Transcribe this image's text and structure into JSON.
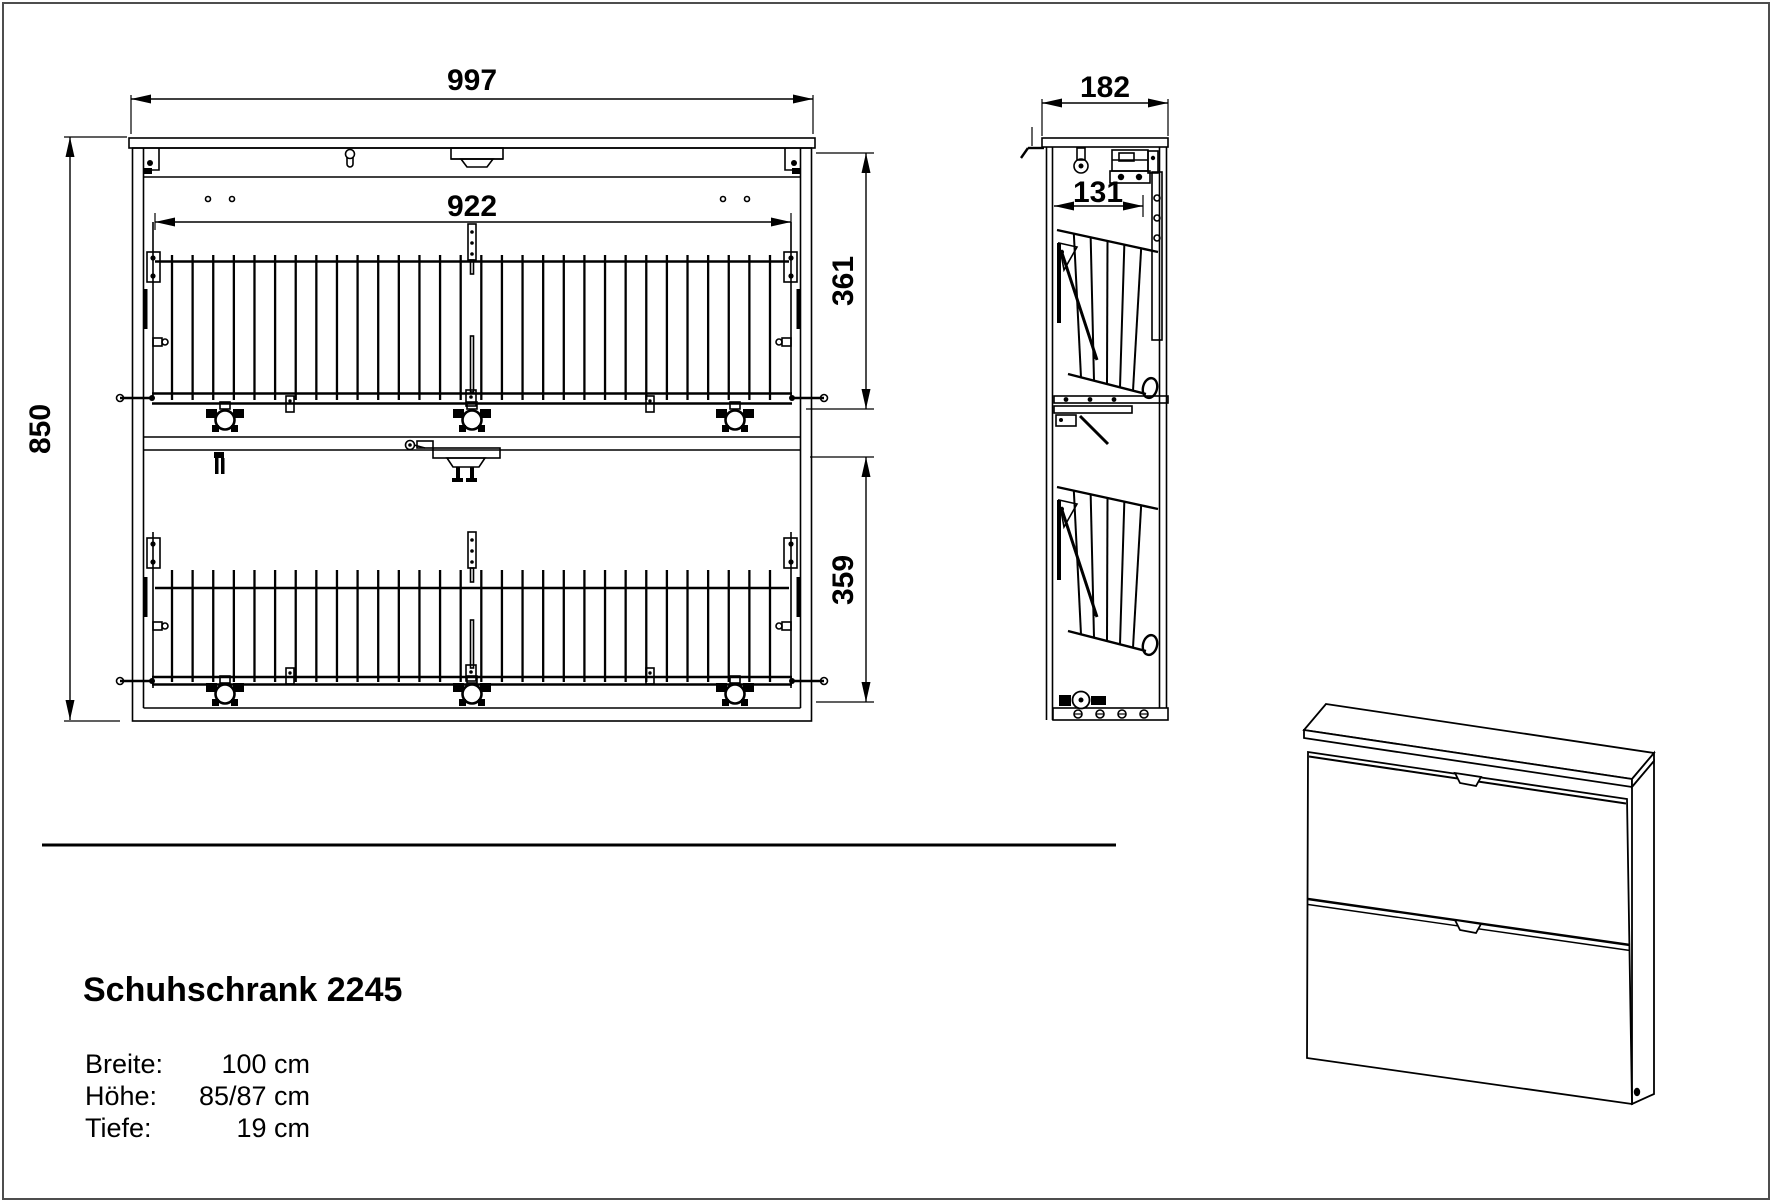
{
  "drawing": {
    "front_view": {
      "width": "997",
      "inner_width": "922",
      "height": "850",
      "upper_compartment": "361",
      "lower_compartment": "359"
    },
    "side_view": {
      "depth": "182",
      "inner_depth": "131"
    }
  },
  "info": {
    "title": "Schuhschrank 2245",
    "specs": [
      {
        "label": "Breite:",
        "value": "100 cm"
      },
      {
        "label": "Höhe:",
        "value": "85/87 cm"
      },
      {
        "label": "Tiefe:",
        "value": "19 cm"
      }
    ]
  },
  "colors": {
    "line": "#000000",
    "background": "#ffffff",
    "border": "#4d4d4d"
  }
}
